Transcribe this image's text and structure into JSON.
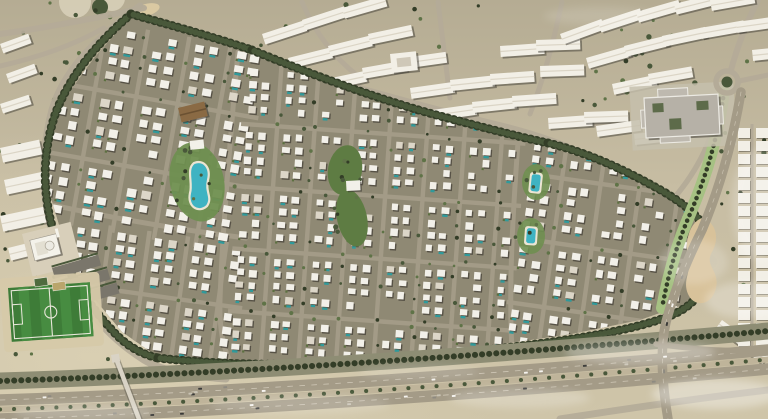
{
  "scene": {
    "width": 768,
    "height": 419,
    "seed": 11,
    "kind": "aerial-masterplan-render"
  },
  "palette": {
    "sand_top": "#b5ac93",
    "sand_mid": "#c7bda3",
    "sand_bottom": "#cfc5a9",
    "sand_light": "#ddd3b6",
    "community_base": "#8f8974",
    "street": "#a39b87",
    "road": "#b4ab98",
    "road_dark": "#a49b87",
    "villa_roof": "#f2f0e9",
    "villa_roof_alt": "#dcd6c8",
    "shadow": "#3e3b33",
    "pool": "#2f9a9b",
    "lagoon": "#3fb3c2",
    "deck": "#ece5d3",
    "tree_dark": "#333d27",
    "tree_mid": "#49583a",
    "tree_light": "#5f7347",
    "park_green": "#5e7c43",
    "lawn": "#6f8f50",
    "boulevard_green": "#a6c183",
    "pitch_a": "#3e7c38",
    "pitch_b": "#478c41",
    "pitch_line": "#e9e7da",
    "slab": "#f2efe6",
    "slab_ridge": "#d8d2c2",
    "plaza": "#c6bfad",
    "civic_base": "#b6b1a7",
    "civic_wing": "#beb9af",
    "civic_trim": "#eceae3",
    "civic_court": "#5d6b4a",
    "asphalt": "#a49b87",
    "median_sand": "#bfb49a",
    "lane_dash": "#d8d1c0",
    "buffer_scrub": "#8e8d74",
    "bridge": "#d9d3c5",
    "mosque_wall": "#f4f2ea",
    "sand_patch": "#d8c29a",
    "garden": "#5c7040",
    "car_colors": [
      "#f5f3ee",
      "#3a3a38",
      "#c9c3b4",
      "#8e8a80",
      "#f5f3ee"
    ]
  },
  "ground": {
    "tree_zones": [
      {
        "x": 0,
        "y": 0,
        "w": 130,
        "h": 118,
        "n": 14
      },
      {
        "x": 560,
        "y": 0,
        "w": 200,
        "h": 58,
        "n": 12
      },
      {
        "x": 690,
        "y": 60,
        "w": 76,
        "h": 270,
        "n": 18
      },
      {
        "x": 0,
        "y": 130,
        "w": 58,
        "h": 160,
        "n": 10
      },
      {
        "x": 6,
        "y": 268,
        "w": 110,
        "h": 92,
        "n": 12
      },
      {
        "x": 545,
        "y": 58,
        "w": 115,
        "h": 60,
        "n": 8
      },
      {
        "x": 256,
        "y": 0,
        "w": 300,
        "h": 48,
        "n": 10
      }
    ],
    "plaza_circles": [
      {
        "cx": 75,
        "cy": 2,
        "r": 16
      },
      {
        "cx": 112,
        "cy": -2,
        "r": 13
      }
    ],
    "green_circle": {
      "cx": 100,
      "cy": 7,
      "r": 8
    },
    "playground": {
      "cx": 146,
      "cy": 10,
      "rx": 14,
      "ry": 6,
      "rot": -15
    }
  },
  "roads": {
    "outer": [
      {
        "d": "M140,6 C96,38 64,70 52,110 C42,148 40,188 52,232 C66,284 96,330 144,360 C162,371 196,377 226,379",
        "w": 7
      },
      {
        "d": "M0,34 C46,28 96,18 144,8",
        "w": 6
      },
      {
        "d": "M0,66 C36,58 72,46 104,28",
        "w": 5
      },
      {
        "d": "M256,58 C330,80 412,104 494,124 C524,131 548,139 568,147",
        "w": 6.5
      },
      {
        "d": "M302,2 C314,30 332,56 358,76",
        "w": 5
      },
      {
        "d": "M438,2 C442,34 446,66 450,98",
        "w": 5
      },
      {
        "d": "M562,2 C554,40 544,78 530,114",
        "w": 5
      },
      {
        "d": "M572,122 C632,130 690,118 722,96",
        "w": 6
      },
      {
        "d": "M731,70 C738,44 748,20 758,0",
        "w": 6
      },
      {
        "d": "M739,81 L768,75",
        "w": 5
      },
      {
        "d": "M723,94 C714,138 698,170 674,198",
        "w": 5.5
      },
      {
        "d": "M52,232 C72,250 92,264 114,278",
        "w": 4.5
      }
    ],
    "main_streets": [
      {
        "d": "M238,52 C230,140 222,240 220,300 C219,330 224,350 230,361",
        "w": 5
      },
      {
        "d": "M20,198 C100,216 180,230 246,238",
        "w": 5
      },
      {
        "d": "M522,90 C514,190 508,280 512,350",
        "w": 5
      }
    ]
  },
  "buildings": {
    "slab_w": 44,
    "slab_h": 11,
    "slabs": [
      [
        262,
        34,
        -18
      ],
      [
        302,
        20,
        -18
      ],
      [
        342,
        8,
        -16
      ],
      [
        288,
        58,
        -14
      ],
      [
        328,
        46,
        -14
      ],
      [
        368,
        34,
        -12
      ],
      [
        322,
        80,
        -12
      ],
      [
        362,
        68,
        -10
      ],
      [
        402,
        58,
        -8
      ],
      [
        410,
        88,
        -8
      ],
      [
        450,
        80,
        -6
      ],
      [
        490,
        74,
        -4
      ],
      [
        432,
        110,
        -8
      ],
      [
        472,
        102,
        -6
      ],
      [
        512,
        96,
        -4
      ],
      [
        500,
        46,
        -4
      ],
      [
        536,
        40,
        -2
      ],
      [
        540,
        66,
        -2
      ],
      [
        548,
        118,
        -4
      ],
      [
        584,
        112,
        -2
      ],
      [
        560,
        34,
        -20
      ],
      [
        598,
        22,
        -18
      ],
      [
        636,
        12,
        -16
      ],
      [
        674,
        4,
        -14
      ],
      [
        710,
        0,
        -10
      ],
      [
        586,
        58,
        -16
      ],
      [
        624,
        46,
        -14
      ],
      [
        662,
        36,
        -12
      ],
      [
        700,
        28,
        -10
      ],
      [
        736,
        22,
        -8
      ],
      [
        612,
        84,
        -12
      ],
      [
        648,
        74,
        -10
      ],
      [
        752,
        50,
        -6
      ],
      [
        596,
        126,
        -8
      ],
      [
        634,
        134,
        -6
      ]
    ],
    "small_slabs": [
      [
        0,
        44,
        -20
      ],
      [
        6,
        74,
        -20
      ],
      [
        0,
        104,
        -18
      ],
      [
        722,
        320,
        36
      ],
      [
        744,
        338,
        36
      ]
    ],
    "small_slab_w": 30,
    "small_slab_h": 10,
    "left_slabs": [
      [
        0,
        148,
        40,
        15,
        -12
      ],
      [
        4,
        180,
        46,
        15,
        -12
      ],
      [
        0,
        216,
        44,
        16,
        -12
      ],
      [
        8,
        248,
        30,
        13,
        -14
      ]
    ],
    "square_building": {
      "x": 390,
      "y": 54,
      "w": 26,
      "h": 19,
      "rot": -6
    },
    "right_columns": {
      "xs": [
        738,
        756
      ],
      "y0": 128,
      "y1": 344,
      "step": 13,
      "w": 12,
      "h": 10,
      "street_x": 752
    }
  },
  "community": {
    "outline": [
      [
        131,
        16
      ],
      [
        176,
        26
      ],
      [
        222,
        38
      ],
      [
        252,
        50
      ],
      [
        312,
        76
      ],
      [
        380,
        101
      ],
      [
        440,
        117
      ],
      [
        516,
        138
      ],
      [
        566,
        152
      ],
      [
        620,
        170
      ],
      [
        664,
        192
      ],
      [
        694,
        220
      ],
      [
        706,
        250
      ],
      [
        700,
        285
      ],
      [
        686,
        304
      ],
      [
        640,
        320
      ],
      [
        572,
        334
      ],
      [
        490,
        346
      ],
      [
        398,
        356
      ],
      [
        300,
        362
      ],
      [
        218,
        362
      ],
      [
        158,
        357
      ],
      [
        122,
        332
      ],
      [
        92,
        296
      ],
      [
        64,
        242
      ],
      [
        48,
        188
      ],
      [
        46,
        142
      ],
      [
        62,
        102
      ],
      [
        94,
        58
      ]
    ],
    "districts": [
      {
        "tx": 30,
        "ty": 14,
        "rot": 10,
        "cols": 17,
        "rows": 14,
        "p": 14,
        "vw": 8.5,
        "vh": 7.5,
        "pool": 0.4,
        "skip": 0.1
      },
      {
        "tx": 78,
        "ty": 226,
        "rot": 8,
        "cols": 13,
        "rows": 11,
        "p": 13,
        "vw": 8,
        "vh": 7,
        "pool": 0.35,
        "skip": 0.1
      },
      {
        "tx": 250,
        "ty": 68,
        "rot": 4,
        "cols": 22,
        "rows": 23,
        "p": 12.5,
        "vw": 7,
        "vh": 6.5,
        "pool": 0.3,
        "skip": 0.1
      },
      {
        "tx": 538,
        "ty": 116,
        "rot": 8,
        "cols": 13,
        "rows": 18,
        "p": 13,
        "vw": 7.5,
        "vh": 7,
        "pool": 0.35,
        "skip": 0.12
      }
    ],
    "boundary_bands": [
      "M131,14 C96,44 70,76 56,112 C44,146 42,182 50,218 C60,262 84,300 112,330 C124,344 140,354 158,358",
      "M131,14 C170,25 210,36 252,50",
      "M252,50 C310,74 380,100 440,116 C478,126 515,136 548,143",
      "M548,143 C585,152 622,168 664,192 C684,204 696,214 702,224",
      "M702,224 C708,248 706,272 696,298",
      "M158,358 C240,367 330,366 420,357 C510,348 600,338 652,322 C672,316 686,310 696,298"
    ]
  },
  "amenities": {
    "lagoon_park": {
      "pad": {
        "cx": 197,
        "cy": 182,
        "rx": 27,
        "ry": 40,
        "rot": -12
      },
      "water": "M194,163 C204,159 211,168 208,180 C205,193 213,197 207,206 C198,214 187,206 190,193 C193,183 186,169 194,163 Z",
      "palms": 9
    },
    "clubhouse": {
      "x": 178,
      "y": 108,
      "w": 27,
      "h": 15,
      "rot": -14,
      "pavilion": {
        "x": 186,
        "y": 142,
        "w": 14,
        "h": 9,
        "rot": -6
      }
    },
    "central_park": {
      "e1": {
        "cx": 345,
        "cy": 170,
        "rx": 17,
        "ry": 25,
        "rot": 10
      },
      "e2": {
        "cx": 352,
        "cy": 218,
        "rx": 15,
        "ry": 29,
        "rot": -12
      },
      "building": {
        "x": 346,
        "y": 181,
        "w": 14,
        "h": 10,
        "rot": -3
      },
      "palms": 10
    },
    "pocket_pools": [
      {
        "x": 532,
        "y": 174,
        "w": 9,
        "h": 17,
        "rot": 6
      },
      {
        "x": 527,
        "y": 228,
        "w": 9,
        "h": 15,
        "rot": 4
      }
    ]
  },
  "civic": {
    "community_center": {
      "rot": -3,
      "plaza": [
        630,
        86,
        104,
        64
      ],
      "base": [
        644,
        98,
        74,
        40
      ],
      "wings": [
        [
          658,
          90,
          30,
          54
        ],
        [
          640,
          110,
          82,
          18
        ]
      ],
      "courts": [
        [
          652,
          104,
          11,
          9
        ],
        [
          696,
          104,
          12,
          9
        ],
        [
          668,
          120,
          12,
          11
        ]
      ]
    },
    "roundabout": {
      "cx": 727,
      "cy": 82,
      "r_outer": 11,
      "r_inner": 5.5
    },
    "boulevard": "M724,92 C718,135 708,172 690,214 C676,246 668,276 662,308",
    "sand_patch": "M702,218 C716,222 720,238 712,252 C704,266 720,270 716,288 C712,306 694,308 688,294 C682,280 692,272 688,258 C684,242 690,222 702,218 Z",
    "mosque": {
      "tx": 22,
      "ty": 234,
      "rot": -14,
      "plaza": [
        0,
        0,
        50,
        44
      ],
      "building": [
        6,
        8,
        27,
        21
      ],
      "court": [
        10,
        12,
        11,
        13
      ],
      "dome": {
        "cx": 24,
        "cy": 18,
        "r": 4.5
      },
      "minaret": [
        33,
        3,
        3,
        9
      ]
    },
    "parking": {
      "tx": 52,
      "ty": 268,
      "rot": -16,
      "rows": [
        [
          0,
          0
        ],
        [
          5,
          16
        ],
        [
          10,
          32
        ]
      ],
      "w": 48,
      "h": 11
    },
    "pitch": {
      "x": 8,
      "y": 288,
      "w": 82,
      "h": 54,
      "rot": -4,
      "stripes": 8,
      "apron": [
        -8,
        -10,
        100,
        74
      ]
    },
    "courts": [
      [
        34,
        279,
        13,
        8,
        -8,
        "#4f6b3e"
      ],
      [
        52,
        283,
        13,
        8,
        -8,
        "#b9a56b"
      ]
    ]
  },
  "highway": {
    "buffer": "M0,381 C250,373 520,353 768,331",
    "carriage_a": "M0,400 C250,392 520,372 768,350",
    "median": "M0,409.5 C250,401.5 520,381.5 768,359.5",
    "carriage_b": "M0,419 C250,411 520,391 768,369",
    "service": "M560,419 C630,408 700,398 768,390",
    "fork_arm": "M656,344 C700,350 734,352 768,350",
    "interchange_road": "M741,92 C733,140 721,185 702,230 C686,262 674,292 666,322 C660,347 662,383 668,419",
    "cars_a": 16,
    "cars_b": 14,
    "cars_x": 5,
    "bridge": {
      "deck": "M117,361 L139,419",
      "landing": [
        111,
        355,
        8,
        8,
        -10
      ]
    }
  },
  "clouds": [
    [
      640,
      352,
      75,
      12,
      0.28
    ],
    [
      716,
      394,
      64,
      15,
      0.36
    ],
    [
      300,
      404,
      90,
      10,
      0.16
    ],
    [
      84,
      412,
      70,
      9,
      0.2
    ],
    [
      758,
      205,
      26,
      55,
      0.22
    ],
    [
      600,
      16,
      56,
      9,
      0.13
    ],
    [
      694,
      262,
      34,
      22,
      0.18
    ],
    [
      420,
      372,
      60,
      8,
      0.13
    ],
    [
      520,
      398,
      70,
      10,
      0.22
    ],
    [
      745,
      300,
      40,
      18,
      0.25
    ]
  ]
}
